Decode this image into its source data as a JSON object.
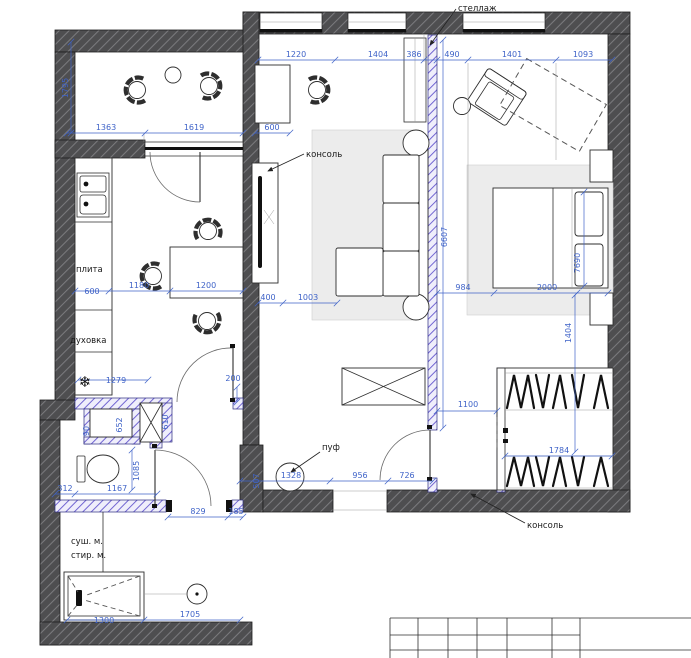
{
  "labels": {
    "shelf": "стеллаж",
    "console_living": "консоль",
    "console_bedroom": "консоль",
    "stove": "плита",
    "oven": "духовка",
    "pouf": "пуф",
    "dryer": "суш. м.",
    "washer": "стир. м."
  },
  "icons": {
    "fridge": "❄"
  },
  "colors": {
    "dimension_blue": "#3f63c8",
    "wall_dark": "#4e4e50",
    "partition_purple": "#6c5fd0"
  },
  "dims": {
    "balcony": {
      "height": "1795",
      "w1": "1363",
      "w2": "1619"
    },
    "top": [
      "1220",
      "1404",
      "386",
      "490",
      "1401",
      "1093"
    ],
    "living": {
      "desk": "600",
      "console": "400",
      "sofa": "1003",
      "partition": "6607"
    },
    "kitchen": {
      "counter": "600",
      "gap": "1180",
      "table": "1200",
      "fridge": "1279",
      "door": "200"
    },
    "bedroom": {
      "offset": "984",
      "bed": "2000",
      "inner": "7690",
      "gap": "1404",
      "ward_door": "1100",
      "ward_width": "1784"
    },
    "wc": {
      "niche": "652",
      "duct": "610",
      "small": "90",
      "depth": "1085",
      "left": "312",
      "width": "1167"
    },
    "hall": {
      "stub": "507",
      "w1": "1328",
      "w2": "956",
      "w3": "726",
      "door": "829",
      "jamb": "185"
    },
    "laundry": {
      "shower": "1300",
      "width": "1705"
    }
  }
}
